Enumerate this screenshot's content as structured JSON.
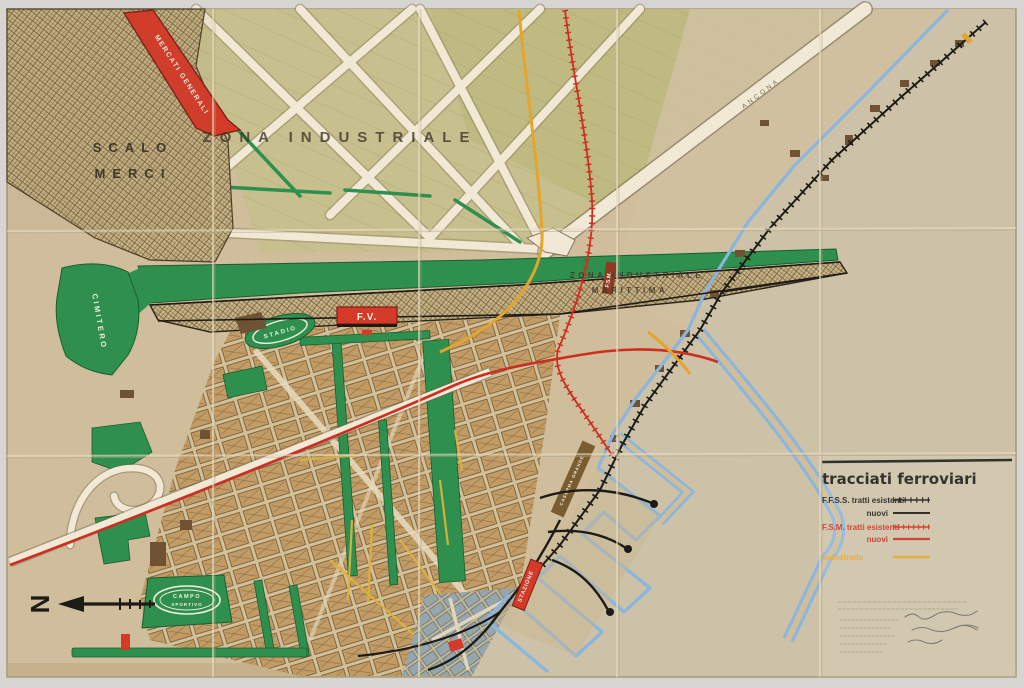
{
  "map": {
    "title": "Piano regolatore — tavola dei tracciati ferroviari (historic hand-drawn port-city map)",
    "labels": {
      "mercati_generali": "MERCATI GENERALI",
      "scalo_line1": "SCALO",
      "scalo_line2": "MERCI",
      "zona_industriale": "ZONA INDUSTRIALE",
      "zim_line1": "ZONA   INDUSTRIALE",
      "zim_line2": "MARITTIMA",
      "cimitero": "CIMITERO",
      "stadio": "STADIO",
      "fv": "F.V.",
      "campo_line1": "CAMPO",
      "campo_line2": "SPORTIVO",
      "fsm_tag": "F.S.M.",
      "stazione": "STAZIONE",
      "caserma": "CASERMA GRANDE",
      "ancona_road": "ANCONA",
      "north": "N"
    },
    "legend": {
      "title": "tracciati ferroviari",
      "entries": [
        {
          "label": "F.F.S.S. tratti esistenti",
          "style": "black-hatched"
        },
        {
          "label": "nuovi",
          "style": "black-solid"
        },
        {
          "label": "F.S.M. tratti esistenti",
          "style": "red-hatched"
        },
        {
          "label": "nuovi",
          "style": "red-solid"
        },
        {
          "label": "autostrada",
          "style": "yellow-solid"
        }
      ]
    },
    "colors": {
      "paper": "#cfbd9b",
      "sea_paper": "#cdc2a7",
      "green": "#2f8f4e",
      "olive_fields": "#c6c18c",
      "station_red": "#d53a28",
      "fsm_red": "#cc2f22",
      "autostrada_yellow": "#e3a52e",
      "harbour_blue": "#8ab5de",
      "railway_black": "#1d1b17",
      "road_white": "#f1e9d6",
      "hatch_brown": "#6f5c36",
      "oldtown_gray": "#97a6ad"
    }
  }
}
